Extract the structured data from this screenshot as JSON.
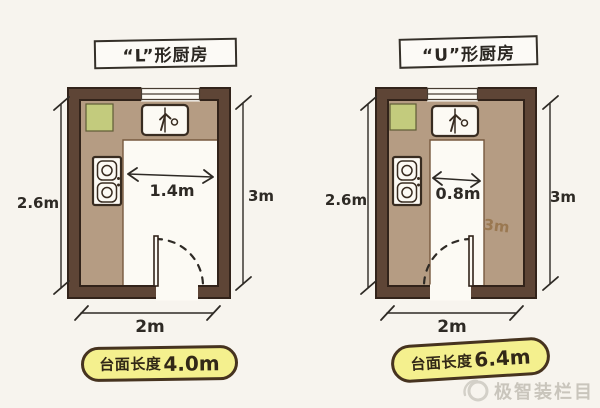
{
  "page": {
    "background": "#f7f4ee"
  },
  "colors": {
    "wall": "#5e4536",
    "wall_outline": "#32231a",
    "countertop": "#b59c83",
    "cutting_board_green": "#c3cb7d",
    "fixture_white": "#fcfaf4",
    "line_dark": "#2e2a25",
    "label_yellow": "#f4f08e",
    "counter_note_brown": "#9a7851",
    "watermark_gray": "#c9c5bc"
  },
  "plans": [
    {
      "title": "“L”形厨房",
      "fixtures": [
        "cutting-board",
        "sink",
        "stove",
        "window",
        "door"
      ],
      "dims": {
        "left_height": "2.6m",
        "right_height": "3m",
        "bottom_width": "2m",
        "aisle_width": "1.4m"
      },
      "label": {
        "prefix": "台面长度",
        "value": "4.0m"
      }
    },
    {
      "title": "“U”形厨房",
      "fixtures": [
        "cutting-board",
        "sink",
        "stove",
        "window",
        "door"
      ],
      "dims": {
        "left_height": "2.6m",
        "right_height": "3m",
        "bottom_width": "2m",
        "aisle_width": "0.8m",
        "counter_length_note": "3m"
      },
      "label": {
        "prefix": "台面长度",
        "value": "6.4m"
      }
    }
  ],
  "watermark": {
    "icon": "swirl-logo",
    "text": "极智装栏目"
  }
}
